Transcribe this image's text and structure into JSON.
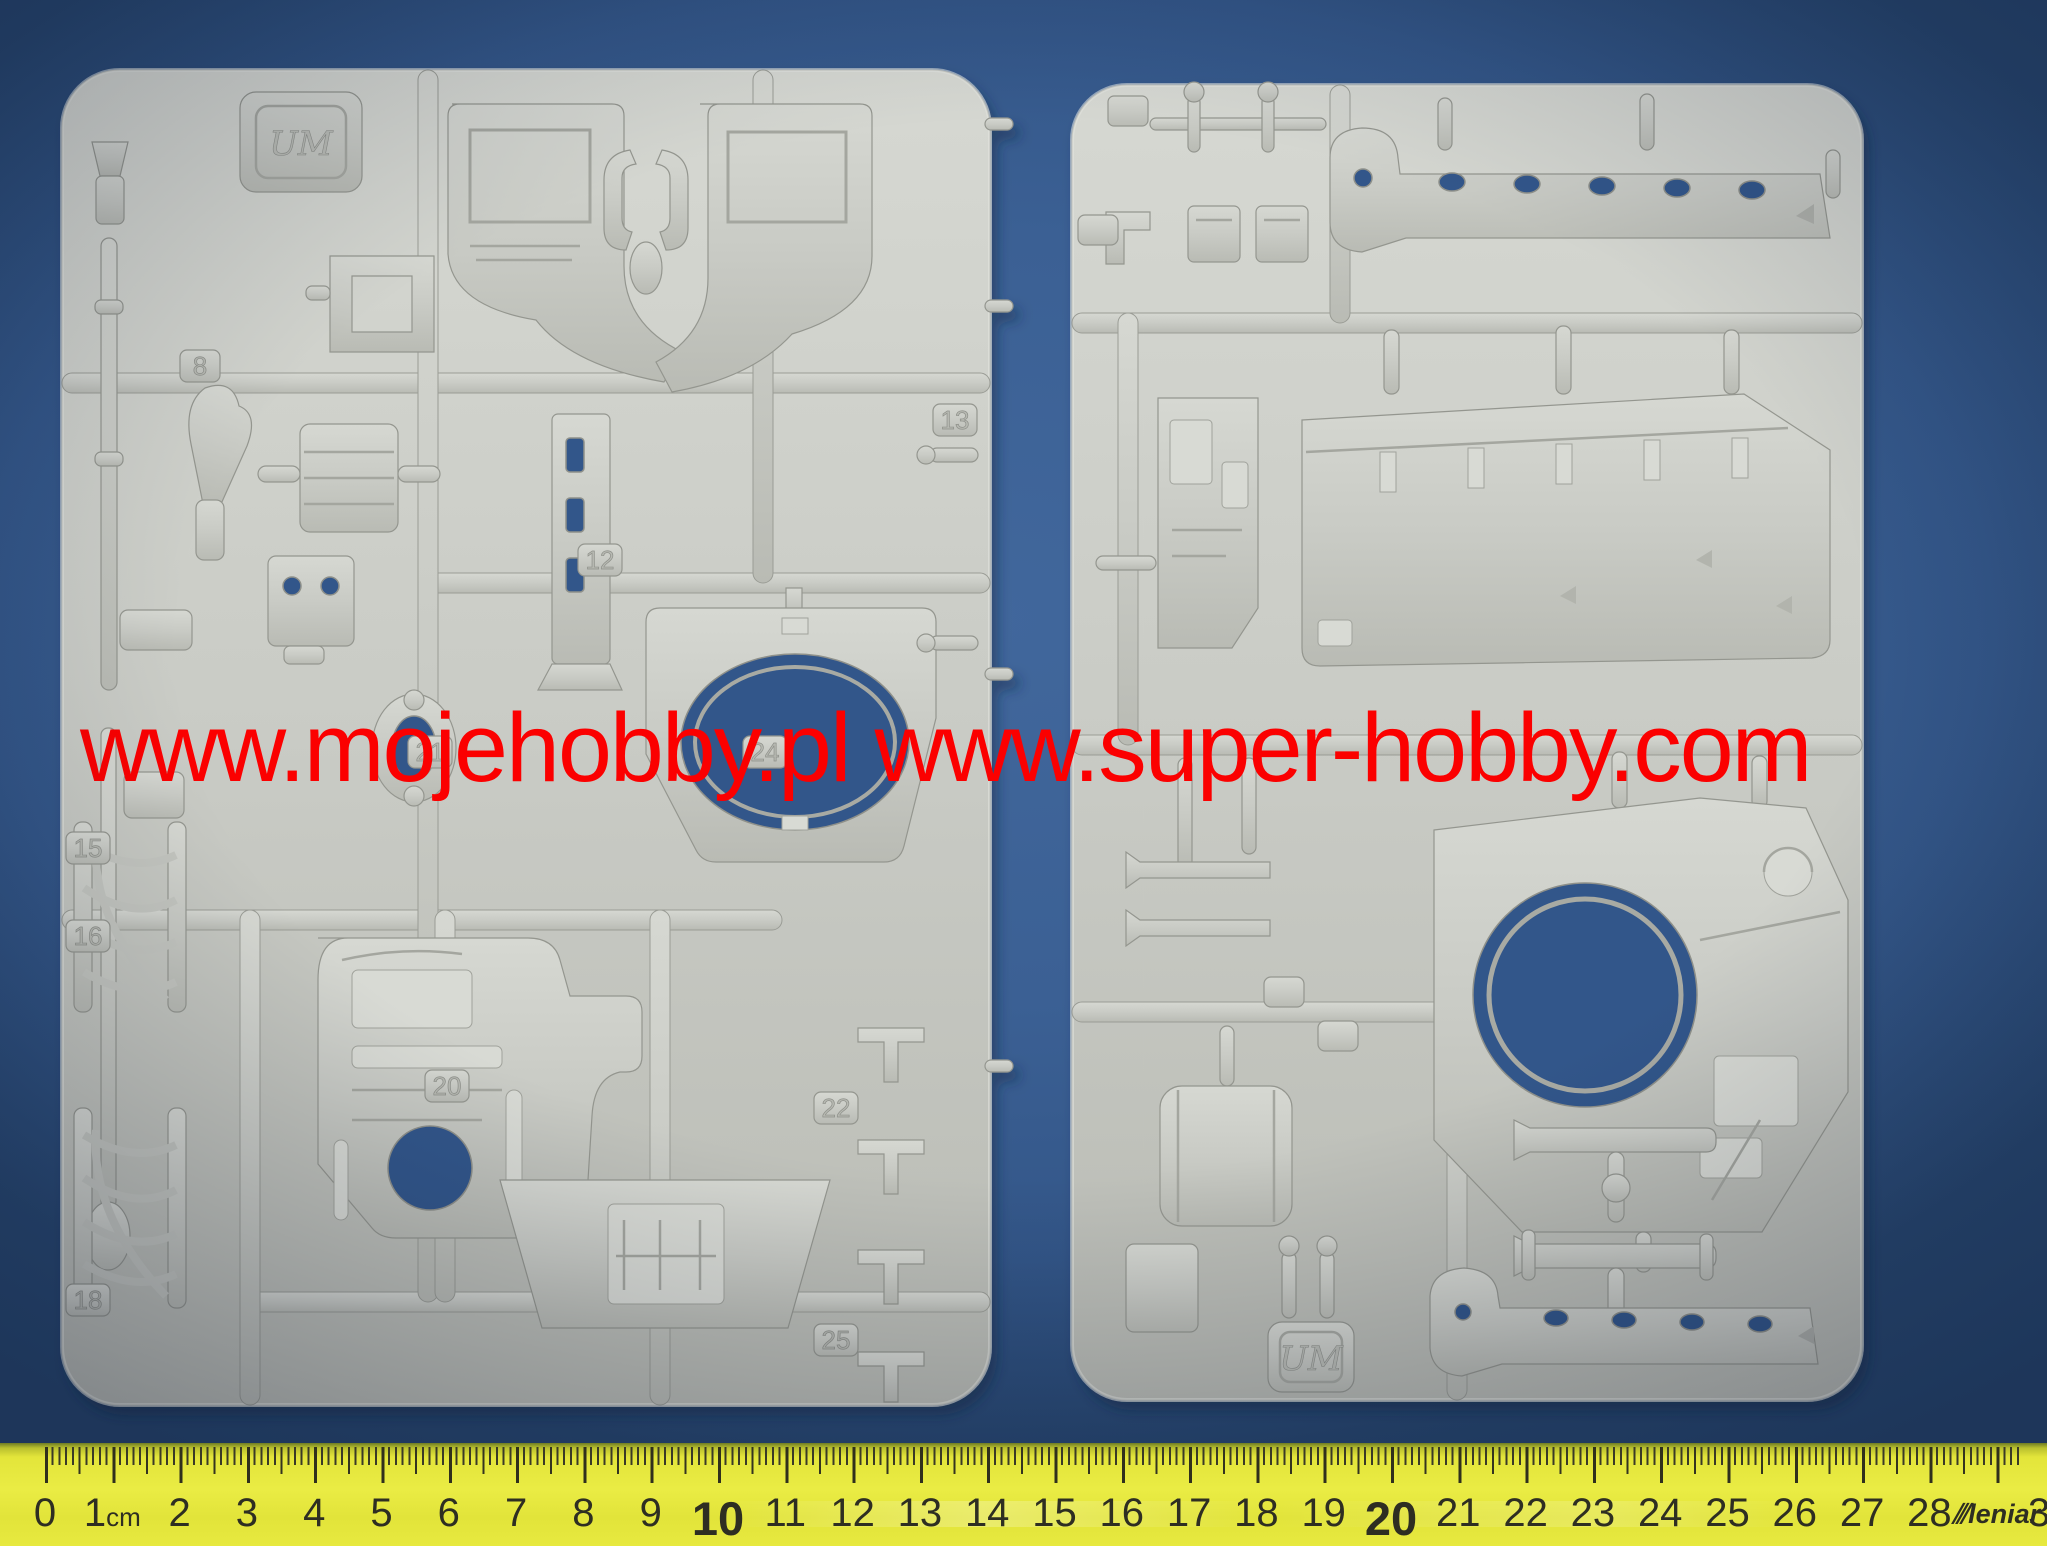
{
  "photo": {
    "watermark": {
      "text": "www.mojehobby.pl www.super-hobby.com",
      "color": "#fb0000"
    },
    "left_sprue": {
      "molded_logo": "UM",
      "part_numbers": [
        "8",
        "12",
        "13",
        "15",
        "16",
        "18",
        "20",
        "21",
        "22",
        "24",
        "25"
      ]
    },
    "right_sprue": {
      "molded_logo": "UM",
      "part_numbers": []
    }
  },
  "ruler": {
    "unit": "cm",
    "tick_labels": [
      "0",
      "1cm",
      "2",
      "3",
      "4",
      "5",
      "6",
      "7",
      "8",
      "9",
      "10",
      "11",
      "12",
      "13",
      "14",
      "15",
      "16",
      "17",
      "18",
      "19",
      "20",
      "21",
      "22",
      "23",
      "24",
      "25",
      "26",
      "27",
      "28"
    ],
    "emphasized_labels": [
      "10",
      "20"
    ],
    "brand_text": "leniar",
    "edge_digit": "3"
  },
  "colors": {
    "background_blue": "#3b6094",
    "plastic_gray": "#c9cbc5",
    "ruler_yellow": "#e8ea3e",
    "watermark_red": "#fb0000",
    "tick_black": "#32321f"
  }
}
